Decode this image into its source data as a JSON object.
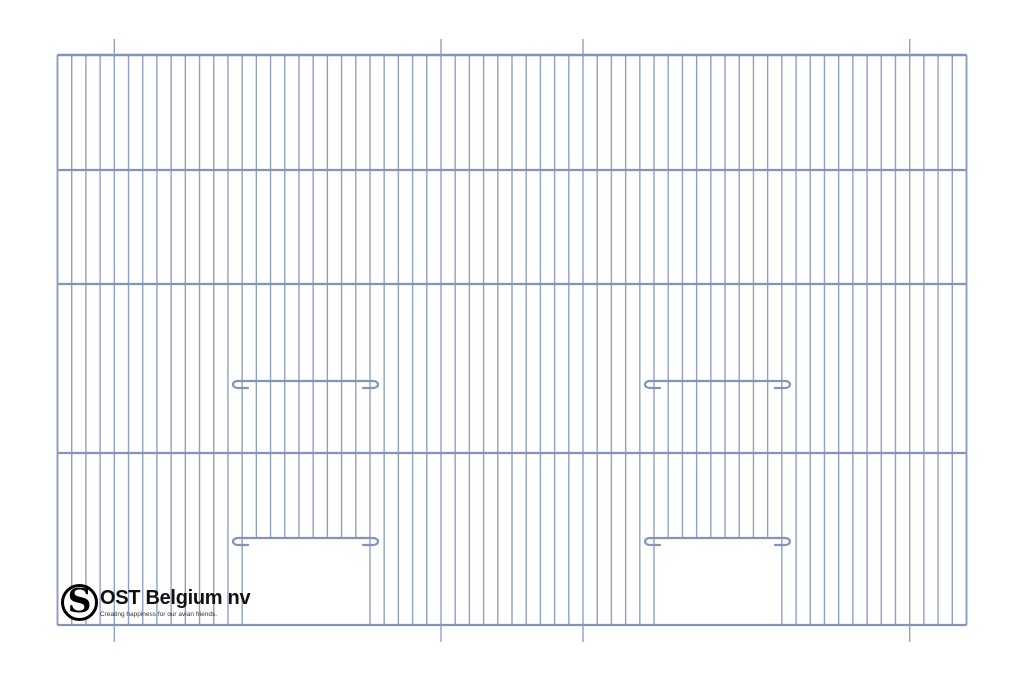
{
  "page": {
    "background": "#ffffff",
    "width": 1024,
    "height": 683
  },
  "logo": {
    "icon": "ost-circle-monogram-icon",
    "monogram": "S",
    "brand": "OST Belgium nv",
    "tagline": "Creating happiness for our avian friends.",
    "brand_color": "#111111",
    "tagline_color": "#333333"
  },
  "drawing": {
    "type": "cage-front-panel-technical-drawing",
    "wire_color_vertical": "#90a0c3",
    "wire_color_horizontal": "#8294b8",
    "panel": {
      "left": 57.5,
      "top": 55,
      "right": 966.5,
      "bottom": 625
    },
    "vertical_wires": {
      "count": 65,
      "spacing": 14.203
    },
    "vertical_wire_width": 1.4,
    "edge_wire_width": 2,
    "horizontal_wires_y": [
      55,
      170,
      284,
      453,
      625
    ],
    "horizontal_wire_width": 2.2,
    "top_edge_width": 2.4,
    "tick_wire_indices": [
      4,
      27,
      37,
      60
    ],
    "tick_length_top": 16,
    "tick_length_bottom": 17,
    "door_openings": [
      {
        "left_wire_index": 13,
        "right_wire_index": 22,
        "top_y": 538,
        "bottom_y": 625
      },
      {
        "left_wire_index": 42,
        "right_wire_index": 51,
        "top_y": 538,
        "bottom_y": 625
      }
    ],
    "slide_bars": [
      {
        "left": 233,
        "right": 378,
        "y": 381
      },
      {
        "left": 645,
        "right": 790,
        "y": 381
      },
      {
        "left": 233,
        "right": 378,
        "y": 538
      },
      {
        "left": 645,
        "right": 790,
        "y": 538
      }
    ],
    "hook": {
      "radius_x": 5,
      "drop": 7,
      "stub": 10
    },
    "bar_width": 2.2
  }
}
